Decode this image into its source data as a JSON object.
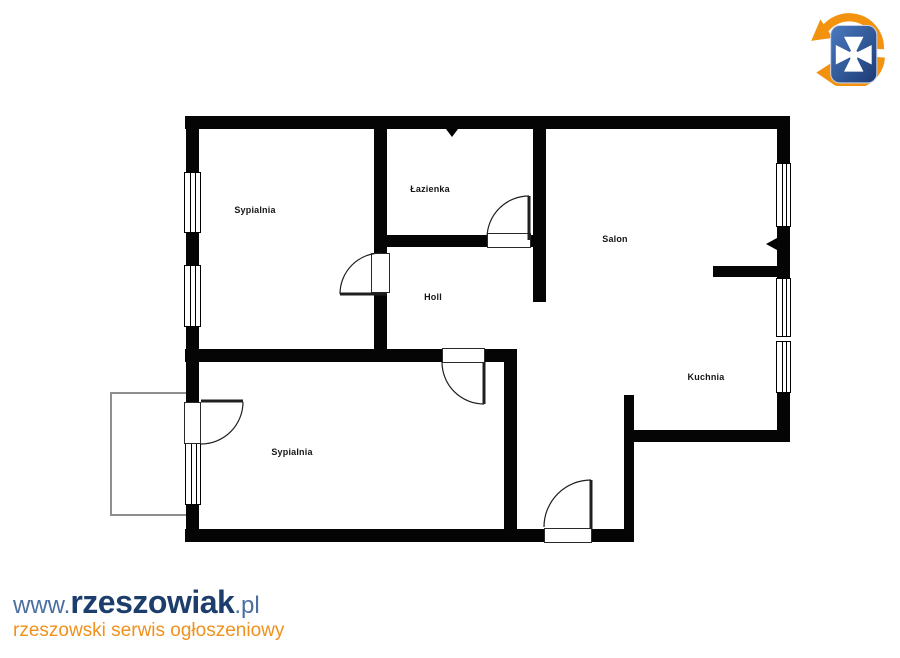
{
  "branding": {
    "logo_name": "rzeszowiak-logo",
    "url_prefix": "www.",
    "site_name": "rzeszowiak",
    "url_suffix": ".pl",
    "tagline": "rzeszowski serwis ogłoszeniowy",
    "colors": {
      "brand_navy": "#1d3e6d",
      "brand_blue": "#4a6fa0",
      "brand_orange": "#f0911c",
      "logo_orange": "#f2920e",
      "logo_blue_dark": "#1c3a74",
      "logo_blue_light": "#4a7ac0"
    }
  },
  "floorplan": {
    "wall_color": "#050505",
    "balcony_outline_color": "#8f8f8f",
    "rooms": [
      {
        "id": "sypialnia-top",
        "label": "Sypialnia"
      },
      {
        "id": "lazienka",
        "label": "Łazienka"
      },
      {
        "id": "salon",
        "label": "Salon"
      },
      {
        "id": "holl",
        "label": "Holl"
      },
      {
        "id": "kuchnia",
        "label": "Kuchnia"
      },
      {
        "id": "sypialnia-bottom",
        "label": "Sypialnia"
      }
    ]
  }
}
